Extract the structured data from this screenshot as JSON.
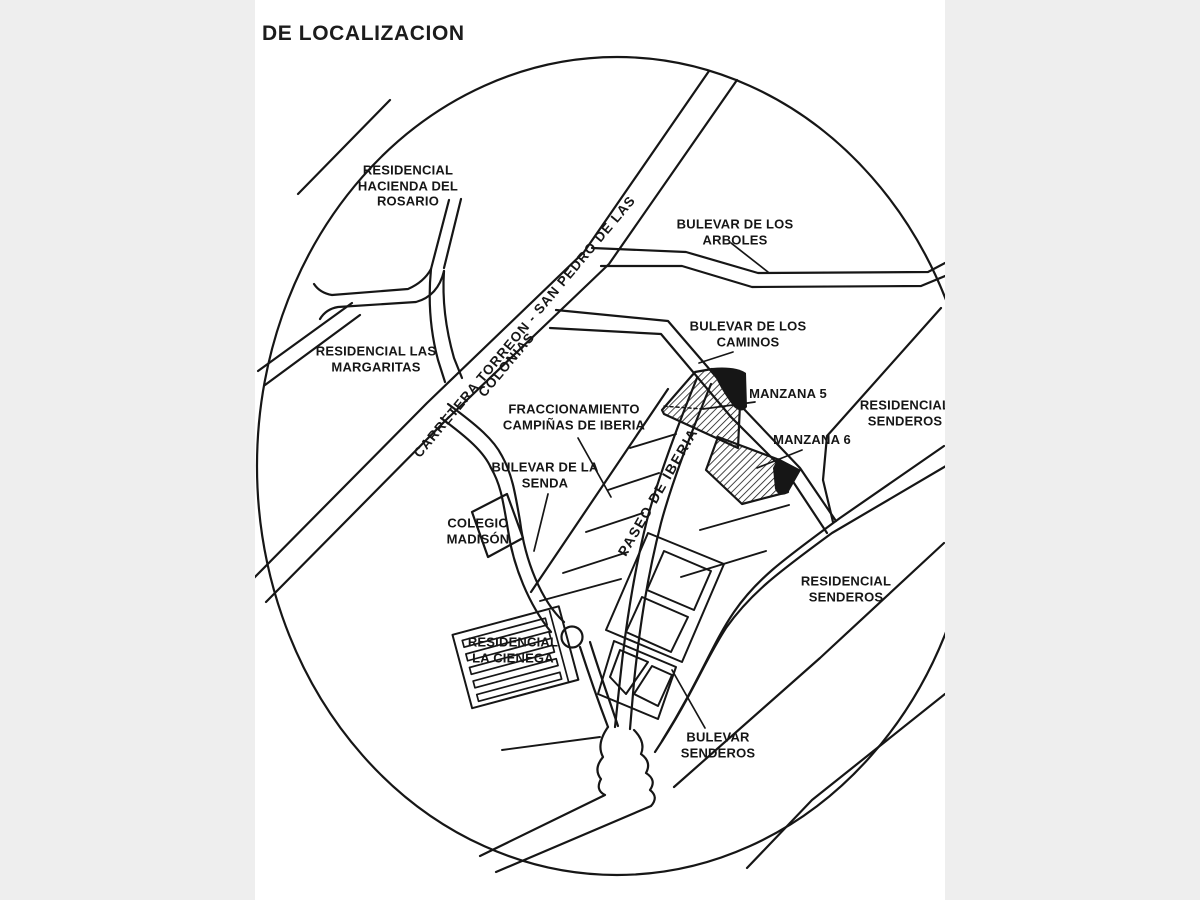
{
  "title": "DE LOCALIZACION",
  "map": {
    "labels": {
      "residencial_hacienda": "RESIDENCIAL\nHACIENDA DEL\nROSARIO",
      "bulevar_arboles": "BULEVAR DE LOS\nARBOLES",
      "carretera_line1": "CARRETERA TORREON - SAN PEDRO DE LAS",
      "carretera_line2": "COLONIAS",
      "residencial_margaritas": "RESIDENCIAL LAS\nMARGARITAS",
      "bulevar_caminos": "BULEVAR DE LOS\nCAMINOS",
      "fraccionamiento": "FRACCIONAMIENTO\nCAMPIÑAS DE IBERIA",
      "manzana5": "MANZANA 5",
      "manzana6": "MANZANA 6",
      "residencial_senderos_ne": "RESIDENCIAL\nSENDEROS",
      "bulevar_senda": "BULEVAR DE LA\nSENDA",
      "colegio_madison": "COLEGIO\nMADISÓN",
      "paseo_iberia": "PASEO DE IBERIA",
      "residencial_cienega": "RESIDENCIAL\nLA CIENEGA",
      "residencial_senderos_se": "RESIDENCIAL\nSENDEROS",
      "bulevar_senderos": "BULEVAR\nSENDEROS"
    },
    "colors": {
      "ink": "#161616",
      "background": "#ffffff",
      "letterbox": "#eeeeee"
    }
  }
}
